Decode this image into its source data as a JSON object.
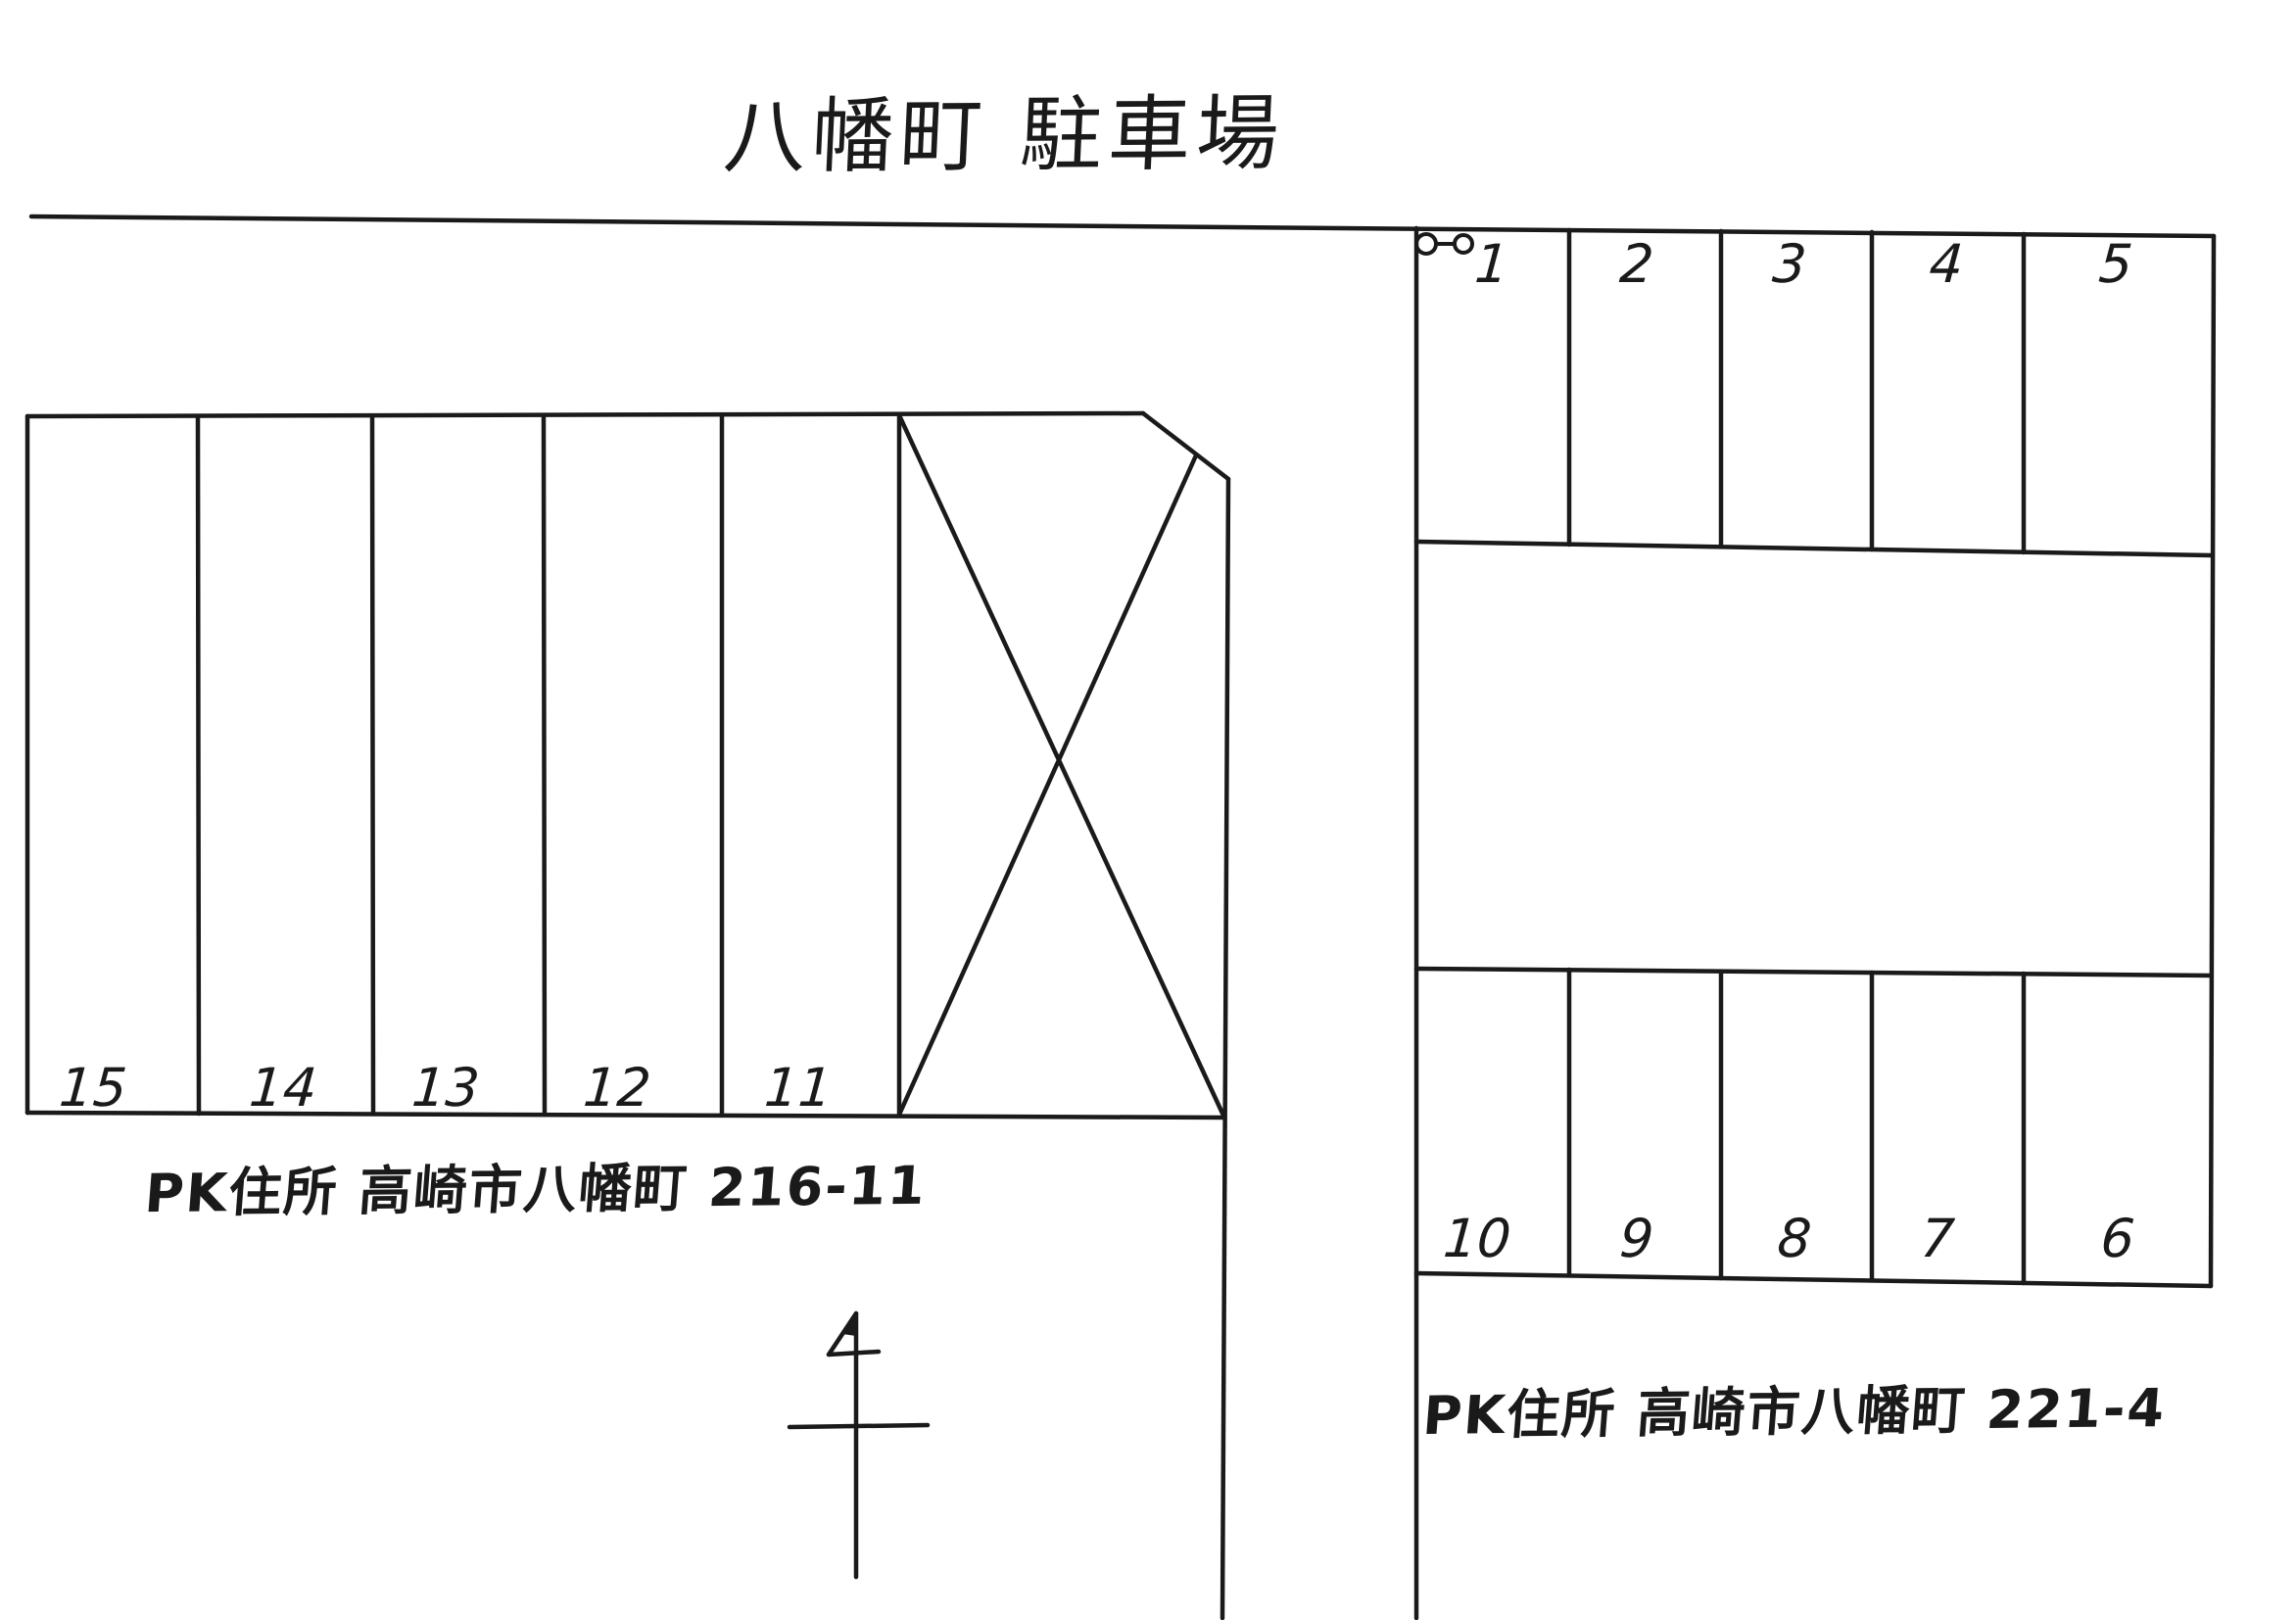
{
  "page": {
    "title": "八幡町 駐車場"
  },
  "left_lot": {
    "spaces": [
      "15",
      "14",
      "13",
      "12",
      "11"
    ],
    "address": "PK住所 高崎市八幡町 216-11"
  },
  "right_lot": {
    "top_spaces": [
      "1",
      "2",
      "3",
      "4",
      "5"
    ],
    "bottom_spaces": [
      "10",
      "9",
      "8",
      "7",
      "6"
    ],
    "address": "PK住所 高崎市八幡町 221-4"
  },
  "icons": {
    "entrance_marker": "gate-marker-icon",
    "compass": "north-arrow-icon",
    "unusable_area": "crossed-area-icon"
  },
  "colors": {
    "ink": "#1a1a1a",
    "paper": "#ffffff"
  }
}
